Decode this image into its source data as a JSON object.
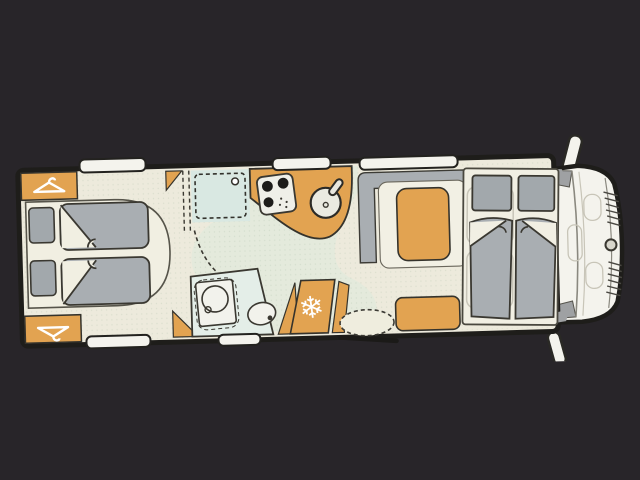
{
  "scene": {
    "name": "Motorhome floor plan, top view on dark background",
    "vehicle_orientation": "rear at left, driver cab at right"
  },
  "colors": {
    "page_bg": "#282529",
    "body_fill": "#EDEADC",
    "body_stroke": "#1E1D1A",
    "floor_tint": "#DDE9DC",
    "floor_dot": "#9DB39B",
    "cabinet_orange": "#E2A351",
    "upholstery_gray": "#A9AEB2",
    "pillow_gray": "#A2A8AC",
    "panel_gray": "#9FA1A3",
    "shower_teal": "#D9E8E2",
    "bath_teal": "#E4EEE8",
    "white_trim": "#F4F3ED",
    "bed_deck": "#F1EFE3",
    "line_dark": "#3A3831",
    "line_mid": "#8A887F",
    "line_faint": "#C8C5B8",
    "icon_white": "#FFFFFF"
  },
  "icons": {
    "snowflake": "❄",
    "wardrobe_hanger": "clothes-hanger",
    "burner": "hob-burner",
    "mirror": "side-mirror"
  },
  "areas": {
    "rear_bedroom": "twin single beds with pillows and two wardrobes",
    "washroom": "shower cabin, toilet and wash basin",
    "kitchen": "worktop with 3-burner hob and round sink",
    "refrigerator": "fridge cabinet with snowflake symbol",
    "lounge": "L-shaped dinette with seat cushions and entry door",
    "front_bed": "drop-down double bed above cab seats",
    "cab": "driver cab with windscreen, grille and side mirrors"
  }
}
